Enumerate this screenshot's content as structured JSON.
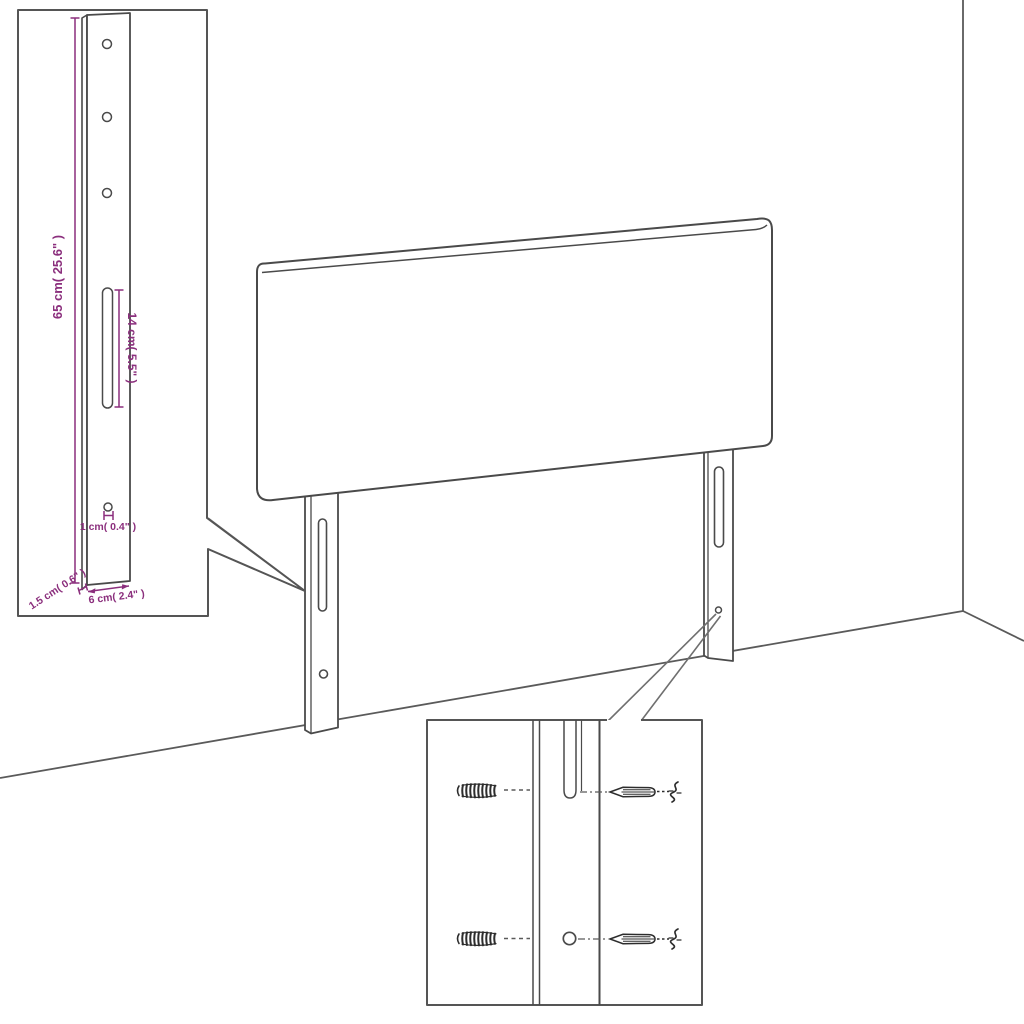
{
  "colors": {
    "background": "#ffffff",
    "line": "#4a4a4a",
    "wall_line": "#5a5a5a",
    "pointer_line": "#6f6f6f",
    "inset_border": "#555555",
    "dimension": "#8b2f7d"
  },
  "bracket_detail": {
    "height_label": "65 cm( 25.6\" )",
    "slot_label": "14 cm( 5.5\" )",
    "hole_label": "1 cm( 0.4\" )",
    "thickness_label": "1.5 cm( 0.6\" )",
    "width_label": "6 cm( 2.4\" )"
  },
  "icons": {
    "wall_plug": "wall-plug-icon",
    "screw": "screw-icon"
  }
}
